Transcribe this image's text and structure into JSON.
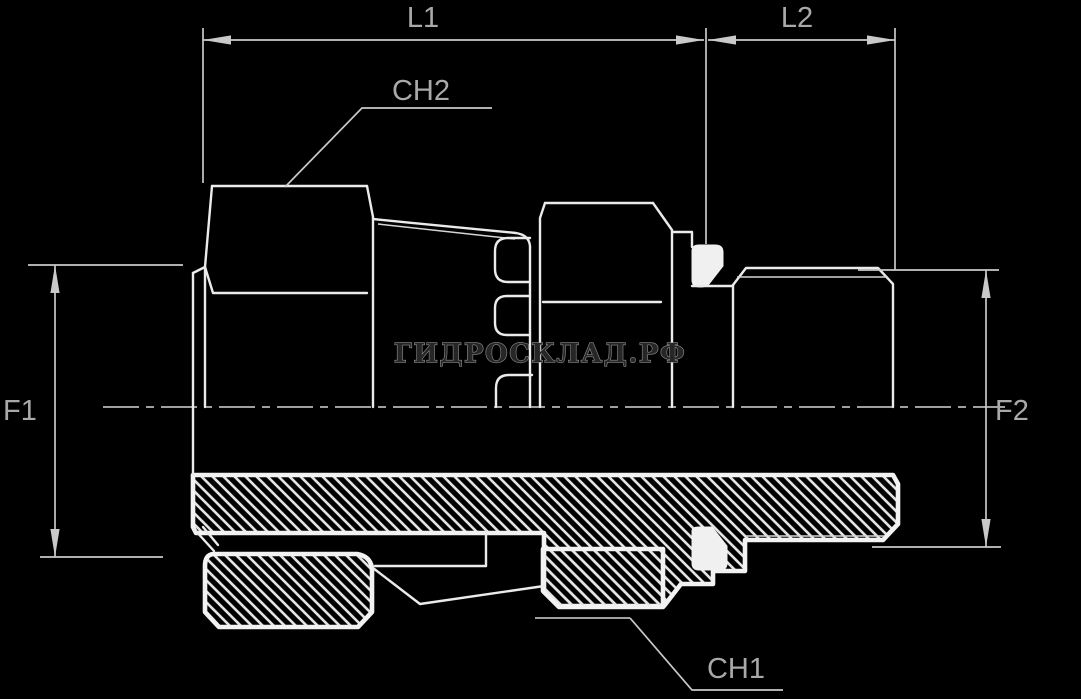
{
  "drawing": {
    "kind": "hydraulic-adapter-section-drawing",
    "watermark": "ГИДРОСКЛАД.РФ",
    "dimensions": {
      "l1": "L1",
      "l2": "L2",
      "f1": "F1",
      "f2": "F2"
    },
    "callouts": {
      "ch1": "CH1",
      "ch2": "CH2"
    },
    "colors": {
      "background": "#000000",
      "outline": "#ebebeb",
      "section_outline": "#f2f2f2",
      "hatch_line": "#e3e3e3",
      "dimension_line": "#c9c9c9",
      "label_text": "#a9a9a9",
      "watermark_outline": "#8f8f8f",
      "watermark_fill": "#262626"
    }
  }
}
